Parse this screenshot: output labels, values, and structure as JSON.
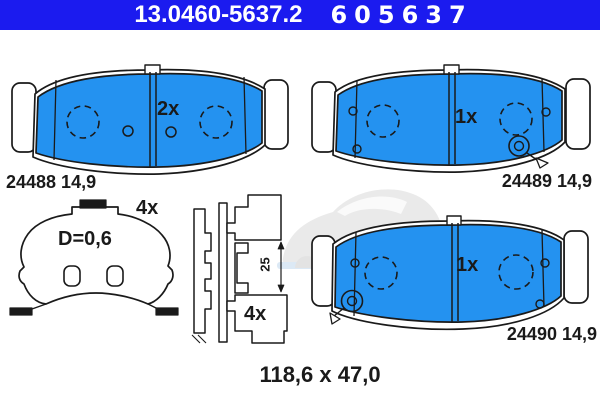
{
  "header": {
    "catalog_number": "13.0460-5637.2",
    "wva_number": "605637"
  },
  "pads": {
    "top_left": {
      "label": "24488 14,9",
      "qty": "2x"
    },
    "top_right": {
      "label": "24489 14,9",
      "qty": "1x"
    },
    "bottom_right": {
      "label": "24490 14,9",
      "qty": "1x"
    }
  },
  "accessories": {
    "shim": {
      "qty": "4x",
      "thickness": "D=0,6"
    },
    "clip": {
      "qty": "4x",
      "height": "25"
    }
  },
  "footer": {
    "dimensions": "118,6 x 47,0"
  },
  "colors": {
    "header_bg": "#1b1bef",
    "pad_fill": "#2492f0",
    "line": "#1a1a1a"
  }
}
